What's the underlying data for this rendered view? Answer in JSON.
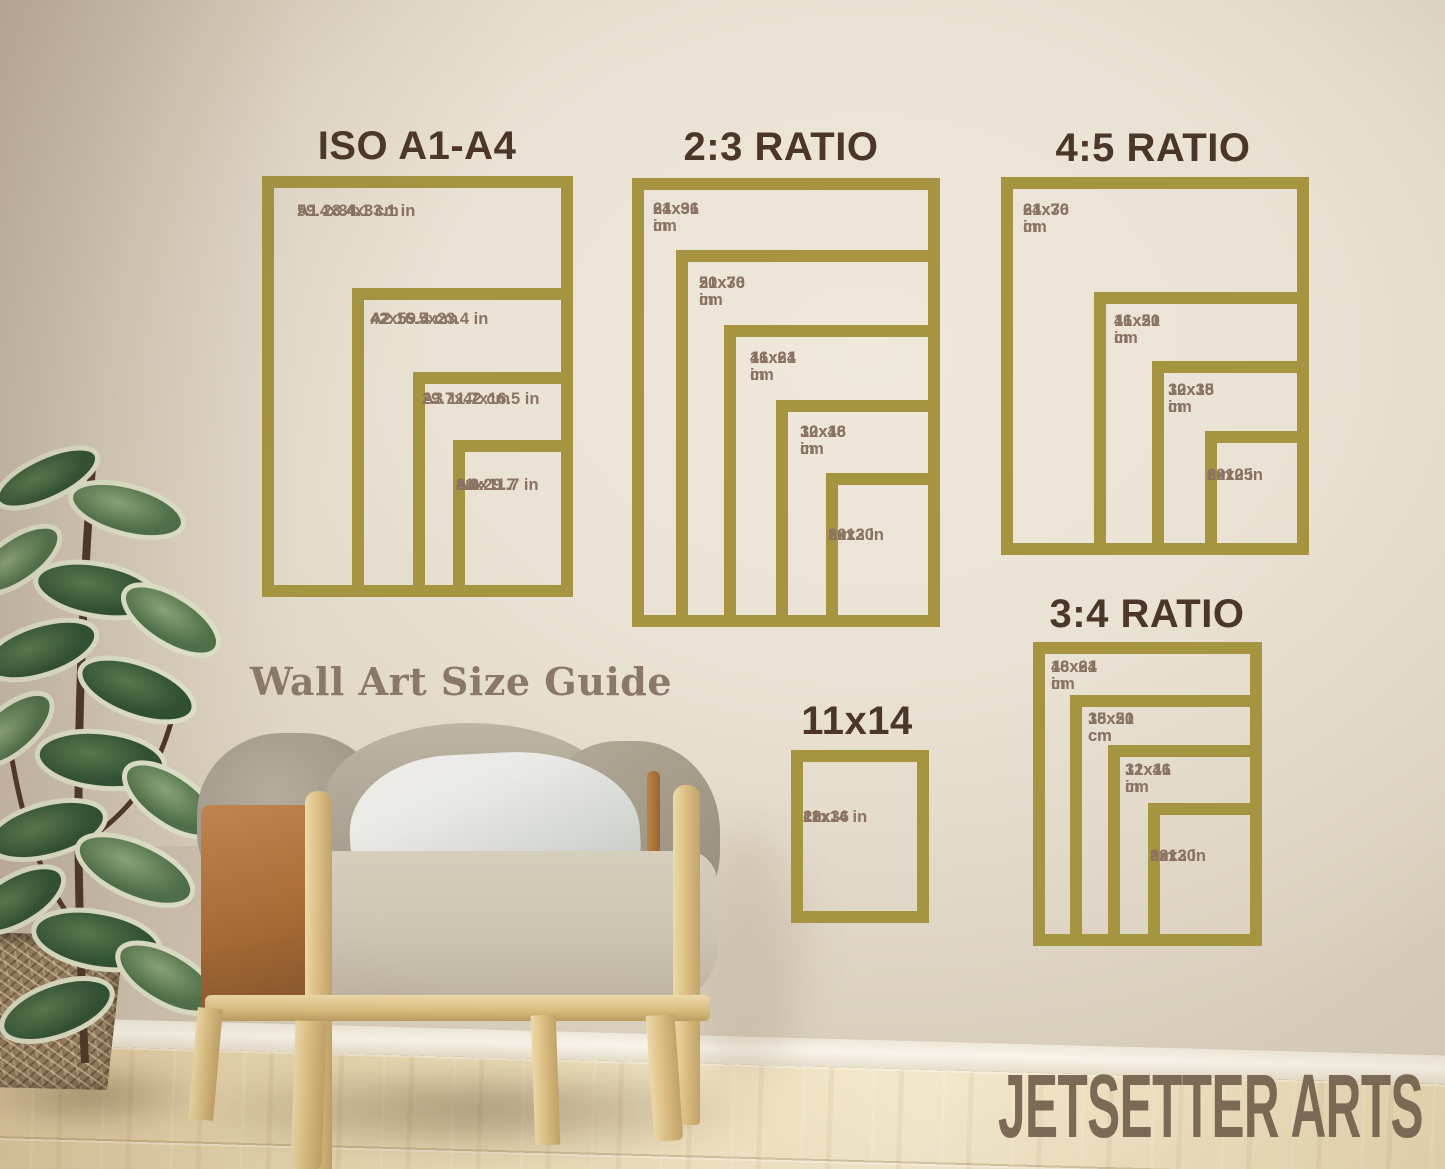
{
  "colors": {
    "frame_gold": "#a59440",
    "section_title": "#4c3627",
    "size_label": "#8b7362",
    "watermark": "#8a7868",
    "brand": "#7c6a57"
  },
  "watermark": {
    "text": "Wall Art Size Guide"
  },
  "brand": {
    "text": "JETSETTER ARTS"
  },
  "sections": {
    "iso": {
      "title": "ISO A1-A4",
      "labels": {
        "a1": [
          "A1 23.4x33.1 in",
          "59.4x84.1 cm"
        ],
        "a2": [
          "A2 16.5x23.4 in",
          "42x59.4 cm"
        ],
        "a3": [
          "A3 11.7x16.5 in",
          "29.7x42 cm"
        ],
        "a4": [
          "A4",
          "8.3x11.7 in",
          "21x29.7",
          "cm"
        ]
      }
    },
    "ratio23": {
      "title": "2:3 RATIO",
      "labels": {
        "s1": [
          "24x36 in",
          "61x91 cm"
        ],
        "s2": [
          "20x30 in",
          "51x76 cm"
        ],
        "s3": [
          "16x24 in",
          "41x61 cm"
        ],
        "s4": [
          "12x18 in",
          "30x46 cm"
        ],
        "s5": [
          "8x12 in",
          "20x30",
          "cm"
        ]
      }
    },
    "ratio45": {
      "title": "4:5 RATIO",
      "labels": {
        "s1": [
          "24x30 in",
          "61x76 cm"
        ],
        "s2": [
          "16x20 in",
          "41x51 cm"
        ],
        "s3": [
          "12x15 in",
          "30x38 cm"
        ],
        "s4": [
          "8x10 in",
          "20x25",
          "cm"
        ]
      }
    },
    "ratio34": {
      "title": "3:4 RATIO",
      "labels": {
        "s1": [
          "18x24 in",
          "46x61 cm"
        ],
        "s2": [
          "15x20 cm",
          "38x51 cm"
        ],
        "s3": [
          "12x16 in",
          "31x41 cm"
        ],
        "s4": [
          "9x12 in",
          "23x30",
          "cm"
        ]
      }
    },
    "size11x14": {
      "title": "11x14",
      "labels": {
        "s1": [
          "11x14 in",
          "28x36",
          "cm"
        ]
      }
    }
  }
}
